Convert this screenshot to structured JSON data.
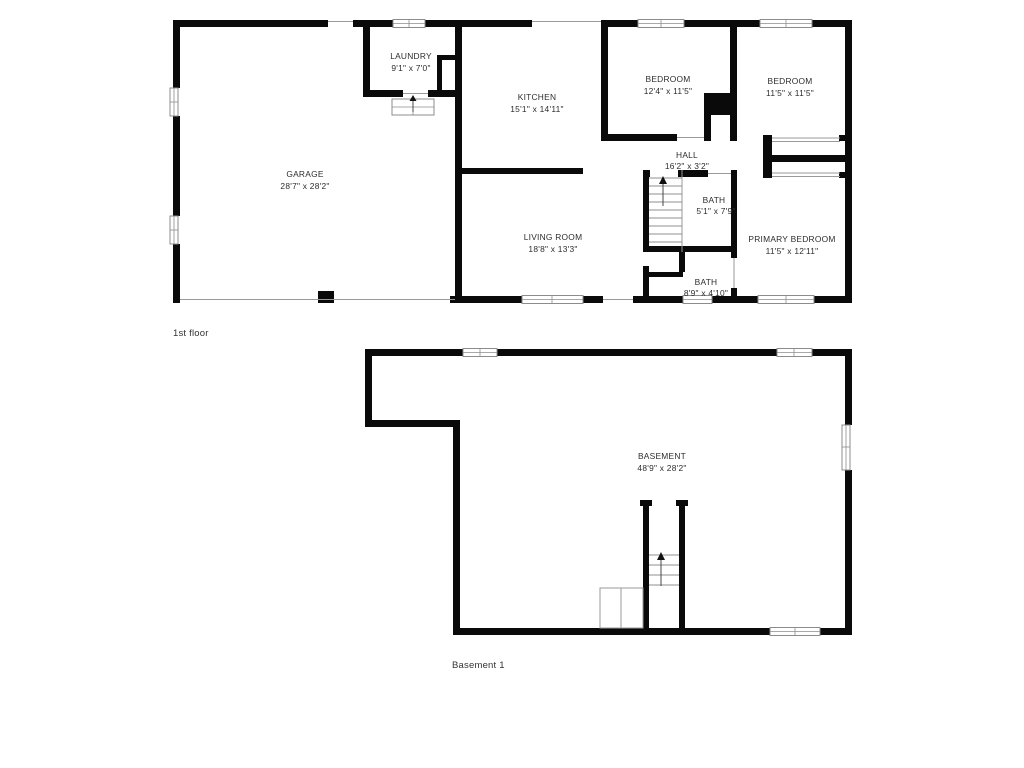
{
  "colors": {
    "background": "#ffffff",
    "wall": "#0a0a0a",
    "thin": "#9a9a9a",
    "label": "#2d2d2d",
    "floor_label": "#333333"
  },
  "floors": {
    "first": {
      "label": "1st floor",
      "rooms": {
        "garage": {
          "name": "GARAGE",
          "dims": "28'7\" x 28'2\""
        },
        "laundry": {
          "name": "LAUNDRY",
          "dims": "9'1\" x 7'0\""
        },
        "kitchen": {
          "name": "KITCHEN",
          "dims": "15'1\" x 14'11\""
        },
        "bedroom1": {
          "name": "BEDROOM",
          "dims": "12'4\" x 11'5\""
        },
        "bedroom2": {
          "name": "BEDROOM",
          "dims": "11'5\" x 11'5\""
        },
        "hall": {
          "name": "HALL",
          "dims": "16'2\" x 3'2\""
        },
        "bath1": {
          "name": "BATH",
          "dims": "5'1\" x 7'9\""
        },
        "living": {
          "name": "LIVING ROOM",
          "dims": "18'8\" x 13'3\""
        },
        "primary": {
          "name": "PRIMARY BEDROOM",
          "dims": "11'5\" x 12'11\""
        },
        "bath2": {
          "name": "BATH",
          "dims": "8'9\" x 4'10\""
        }
      }
    },
    "basement": {
      "label": "Basement 1",
      "rooms": {
        "basement": {
          "name": "BASEMENT",
          "dims": "48'9\" x 28'2\""
        }
      }
    }
  }
}
